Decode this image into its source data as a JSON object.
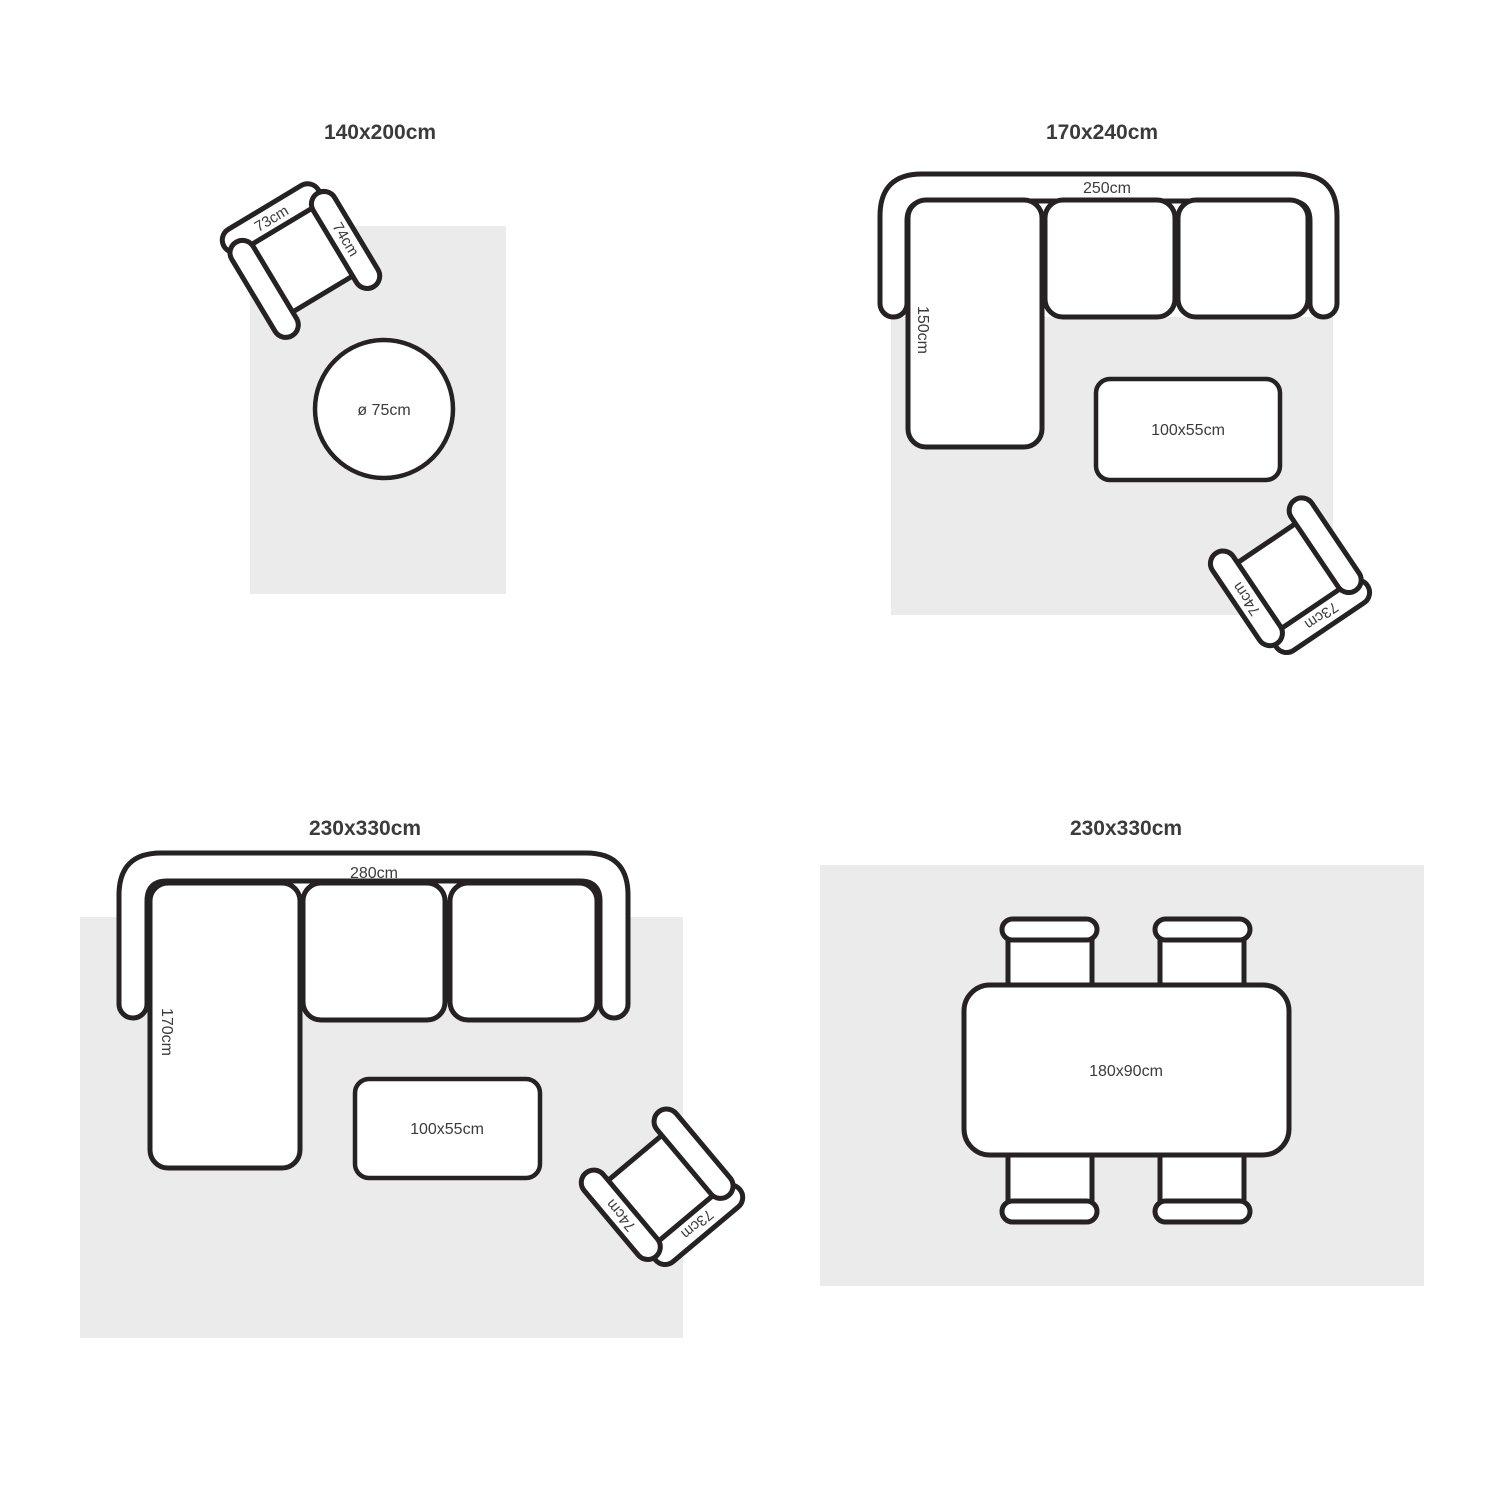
{
  "colors": {
    "rug_fill": "#ebebeb",
    "outline": "#262122",
    "text": "#3b3b3b",
    "background": "#ffffff"
  },
  "sections": {
    "s1": {
      "title": "140x200cm",
      "chair": {
        "back": "73cm",
        "arm": "74cm"
      },
      "round_table": "ø 75cm"
    },
    "s2": {
      "title": "170x240cm",
      "sofa": {
        "width": "250cm",
        "depth": "150cm"
      },
      "coffee_table": "100x55cm",
      "chair": {
        "back": "73cm",
        "arm": "74cm"
      }
    },
    "s3": {
      "title": "230x330cm",
      "sofa": {
        "width": "280cm",
        "depth": "170cm"
      },
      "coffee_table": "100x55cm",
      "chair": {
        "back": "73cm",
        "arm": "74cm"
      }
    },
    "s4": {
      "title": "230x330cm",
      "dining_table": "180x90cm"
    }
  }
}
